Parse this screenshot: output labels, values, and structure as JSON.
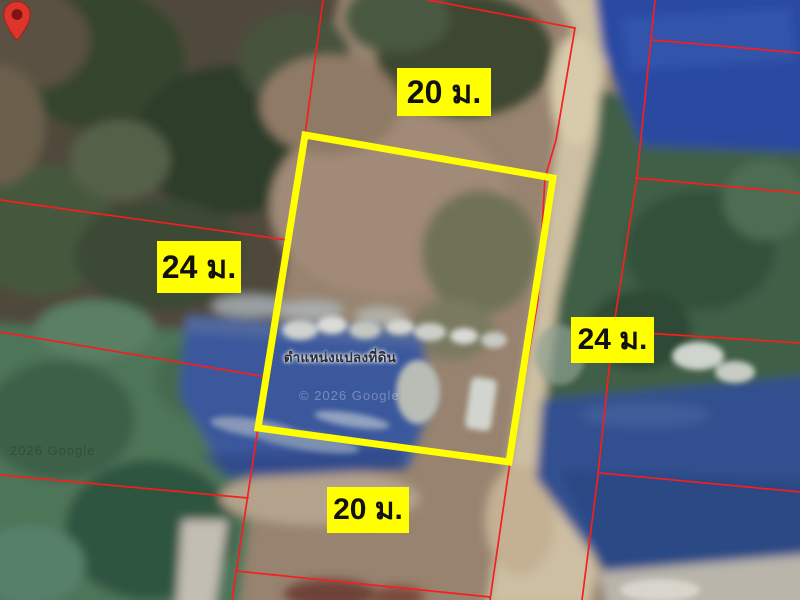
{
  "map": {
    "view_type": "satellite",
    "parcel_labels": {
      "top": "20 ม.",
      "left": "24 ม.",
      "right": "24 ม.",
      "bottom": "20 ม."
    },
    "pin": {
      "caption": "ตำแหน่งแปลงที่ดิน"
    },
    "watermarks": {
      "center": "© 2026 Google",
      "corner": "2026 Google"
    },
    "colors": {
      "parcel_outline": "#ffff00",
      "boundary_lines": "#f61e1e",
      "label_background": "#ffff00",
      "label_text": "#111111",
      "pin": "#dd352b"
    }
  }
}
